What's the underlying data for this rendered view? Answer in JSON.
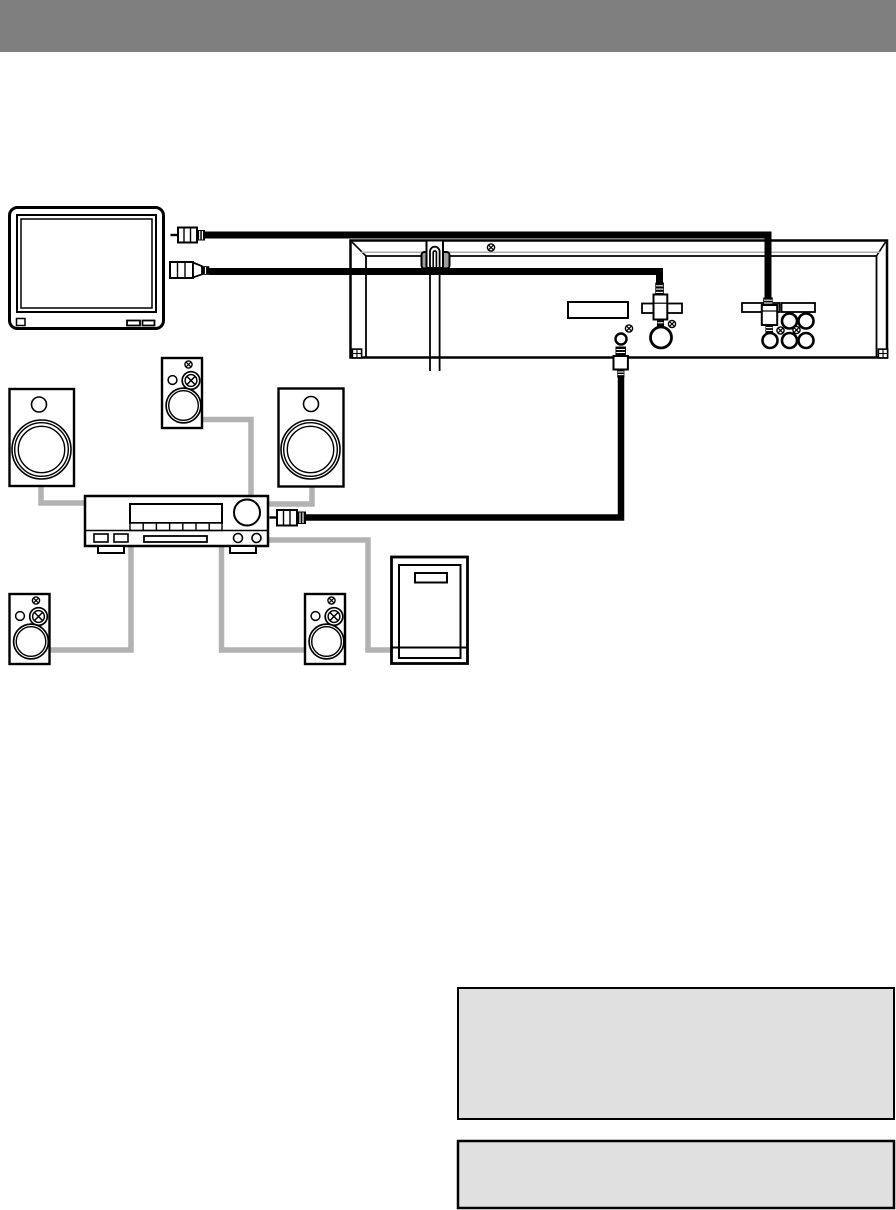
{
  "colors": {
    "ink": "#000000",
    "paper": "#ffffff",
    "header_gray": "#7f7f7f",
    "note_fill": "#e0e0e0",
    "wire_gray": "#b2b2b2",
    "shade_gray": "#b0b0b0",
    "clamp_gray": "#9e9e9e"
  },
  "components": {
    "header_bar": "solid gray page title band (no legible text)",
    "tv": "television with two AV plugs at its right side",
    "dvd_rear_panel": "dvd player rear panel with cord clamp, label plates, s-video jack, digital audio jack, 2x3 rca jack block",
    "amplifier": "av amplifier/receiver front panel",
    "speakers": [
      "front-left",
      "center",
      "front-right",
      "surround-left",
      "surround-right"
    ],
    "subwoofer": "subwoofer cabinet",
    "black_cables": [
      "video cable tv to rca jack block",
      "s-video cable tv to s-video jack",
      "audio cable dvd jack to amplifier rca plug"
    ],
    "speaker_wires": 6,
    "note_boxes": 2
  }
}
